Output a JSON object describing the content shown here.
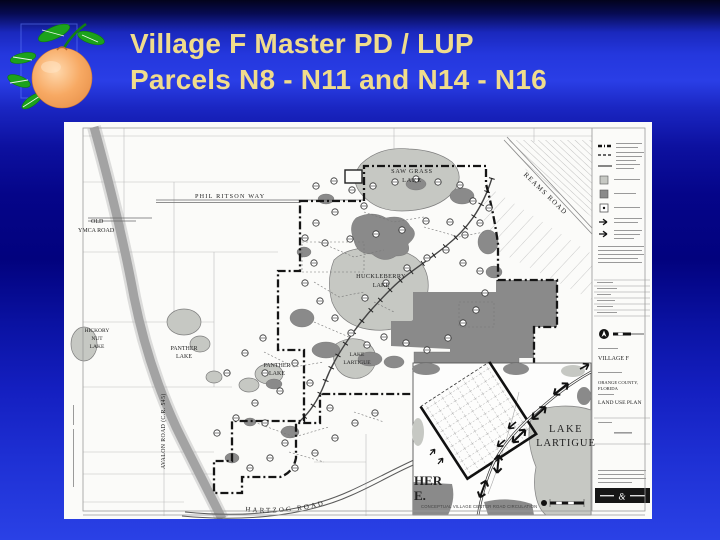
{
  "slide": {
    "title_line1": "Village F Master PD / LUP",
    "title_line2": "Parcels N8 - N11 and N14 - N16",
    "title_color": "#F0DC8C",
    "background_colors": {
      "banner_blue": "#2437dd",
      "deep_blue": "#02027e"
    }
  },
  "logo": {
    "icon": "orange-fruit-clipart"
  },
  "map": {
    "colors": {
      "paper": "#fbfbf9",
      "lake": "#c6c8c3",
      "wetland": "#8a8a8a",
      "ink": "#222222"
    },
    "labels": {
      "phil_ritson_way": "PHIL RITSON WAY",
      "old_ymca_road": [
        "OLD",
        "YMCA ROAD"
      ],
      "hickory_nut_lake": [
        "HICKORY",
        "NUT",
        "LAKE"
      ],
      "saw_grass_lake": [
        "SAW GRASS",
        "LAKE"
      ],
      "huckleberry_lake": [
        "HUCKLEBERRY",
        "LAKE"
      ],
      "panther_lake_a": [
        "PANTHER",
        "LAKE"
      ],
      "panther_lake_b": [
        "PANTHER",
        "LAKE"
      ],
      "lake_lartigue_small": [
        "LAKE",
        "LARTIGUE"
      ],
      "reams_road": "REAMS ROAD",
      "avalon_road": "AVALON ROAD (C.R. 545)",
      "hartzog_road": "HARTZOG ROAD",
      "lake_lartigue_inset": [
        "LAKE",
        "LARTIGUE"
      ],
      "cut_label": [
        "HER",
        "E."
      ],
      "inset_caption": "CONCEPTUAL VILLAGE CENTER ROAD CIRCULATION"
    },
    "titleblock": {
      "project": "VILLAGE F",
      "county": [
        "ORANGE COUNTY,",
        "FLORIDA"
      ],
      "sheet_title": "LAND USE PLAN",
      "ampersand": "&"
    },
    "legend_symbols": [
      "boundary-bold-dashdot-line",
      "phase-dashed-line",
      "solid-line",
      "water-body-square",
      "wetland-square",
      "parcel-id-square",
      "flow-arrow",
      "access-arrow"
    ],
    "markers": [
      [
        252,
        64
      ],
      [
        270,
        59
      ],
      [
        288,
        68
      ],
      [
        309,
        64
      ],
      [
        331,
        60
      ],
      [
        352,
        57
      ],
      [
        374,
        60
      ],
      [
        396,
        63
      ],
      [
        409,
        79
      ],
      [
        300,
        84
      ],
      [
        271,
        90
      ],
      [
        252,
        101
      ],
      [
        241,
        116
      ],
      [
        261,
        121
      ],
      [
        286,
        117
      ],
      [
        312,
        112
      ],
      [
        338,
        108
      ],
      [
        362,
        99
      ],
      [
        386,
        100
      ],
      [
        401,
        113
      ],
      [
        416,
        101
      ],
      [
        425,
        86
      ],
      [
        250,
        141
      ],
      [
        241,
        161
      ],
      [
        256,
        179
      ],
      [
        271,
        196
      ],
      [
        287,
        211
      ],
      [
        303,
        223
      ],
      [
        320,
        215
      ],
      [
        342,
        221
      ],
      [
        363,
        228
      ],
      [
        384,
        216
      ],
      [
        399,
        201
      ],
      [
        412,
        188
      ],
      [
        421,
        171
      ],
      [
        301,
        176
      ],
      [
        322,
        161
      ],
      [
        343,
        146
      ],
      [
        363,
        136
      ],
      [
        382,
        128
      ],
      [
        399,
        141
      ],
      [
        416,
        149
      ],
      [
        199,
        216
      ],
      [
        181,
        231
      ],
      [
        163,
        251
      ],
      [
        201,
        251
      ],
      [
        216,
        269
      ],
      [
        191,
        281
      ],
      [
        172,
        296
      ],
      [
        153,
        311
      ],
      [
        201,
        301
      ],
      [
        221,
        321
      ],
      [
        206,
        336
      ],
      [
        186,
        346
      ],
      [
        231,
        346
      ],
      [
        251,
        331
      ],
      [
        271,
        316
      ],
      [
        291,
        301
      ],
      [
        311,
        291
      ],
      [
        266,
        286
      ],
      [
        246,
        261
      ],
      [
        231,
        241
      ]
    ]
  }
}
